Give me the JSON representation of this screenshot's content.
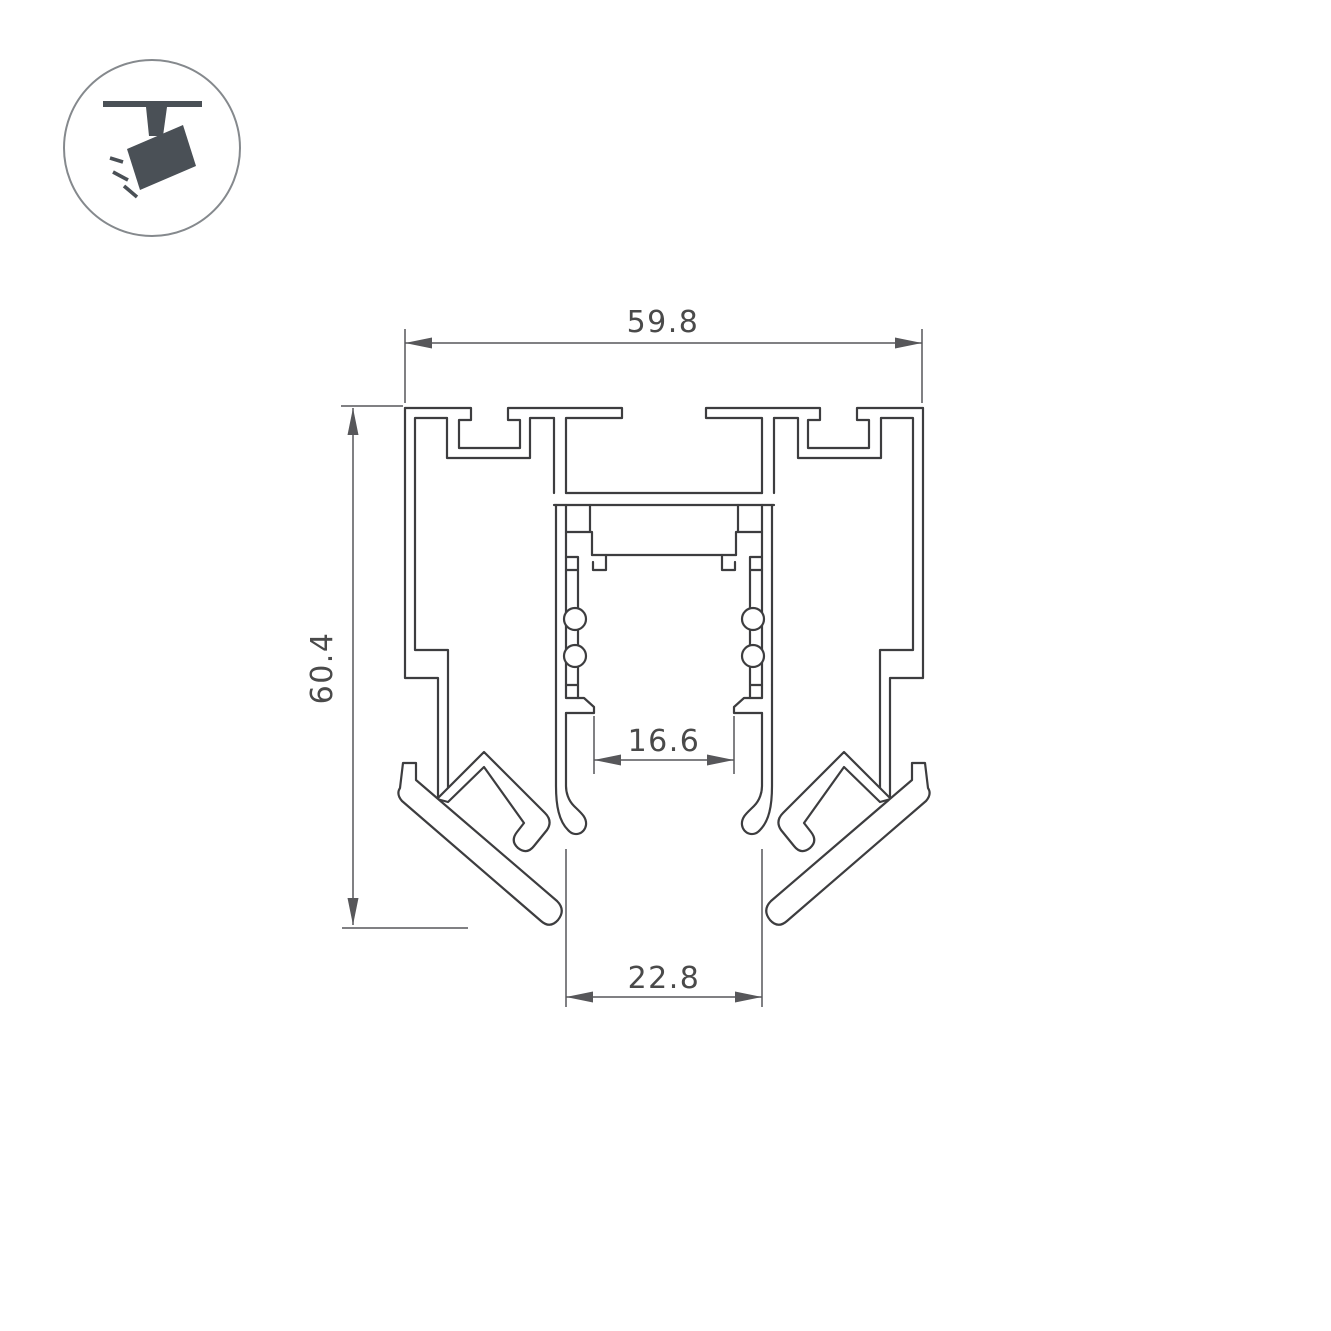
{
  "drawing": {
    "title": "profile-cross-section",
    "dimensions": {
      "width_top": "59.8",
      "height_left": "60.4",
      "slot_width": "16.6",
      "bottom_width": "22.8"
    },
    "colors": {
      "line": "#3d3d3f",
      "dimension_line": "#57575a",
      "text": "#4a4a4a",
      "icon": "#4a5056",
      "background": "#ffffff"
    }
  },
  "icon": {
    "name": "ceiling-spotlight-icon"
  }
}
